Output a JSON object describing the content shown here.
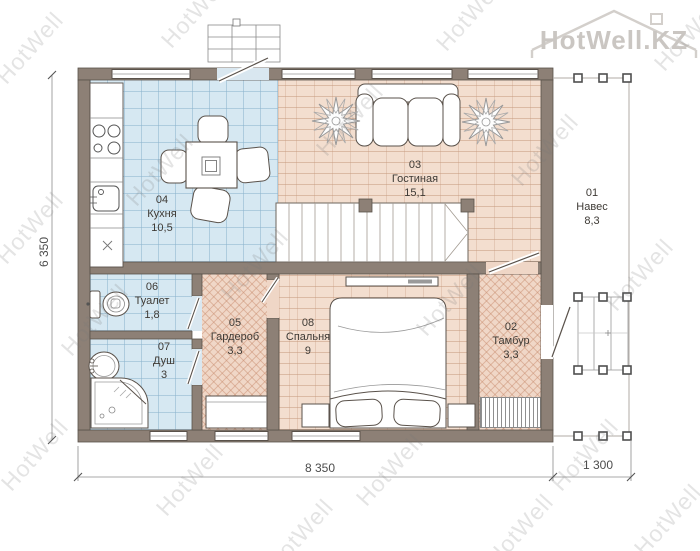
{
  "logo": {
    "text": "HotWell.KZ"
  },
  "watermark": {
    "text": "HotWell"
  },
  "rooms": [
    {
      "number": "01",
      "name": "Навес",
      "area": "8,3"
    },
    {
      "number": "02",
      "name": "Тамбур",
      "area": "3,3"
    },
    {
      "number": "03",
      "name": "Гостиная",
      "area": "15,1"
    },
    {
      "number": "04",
      "name": "Кухня",
      "area": "10,5"
    },
    {
      "number": "05",
      "name": "Гардероб",
      "area": "3,3"
    },
    {
      "number": "06",
      "name": "Туалет",
      "area": "1,8"
    },
    {
      "number": "07",
      "name": "Душ",
      "area": "3"
    },
    {
      "number": "08",
      "name": "Спальня",
      "area": "9"
    }
  ],
  "dimensions": {
    "left": "6 350",
    "bottom_main": "8 350",
    "bottom_side": "1 300"
  },
  "colors": {
    "wall": "#8d8076",
    "tile_floor": "#d6e8f2",
    "parquet_floor": "#f3decf",
    "herringbone_floor": "#f0d7c7",
    "line": "#5a524b",
    "watermark": "#d9d9d9"
  }
}
